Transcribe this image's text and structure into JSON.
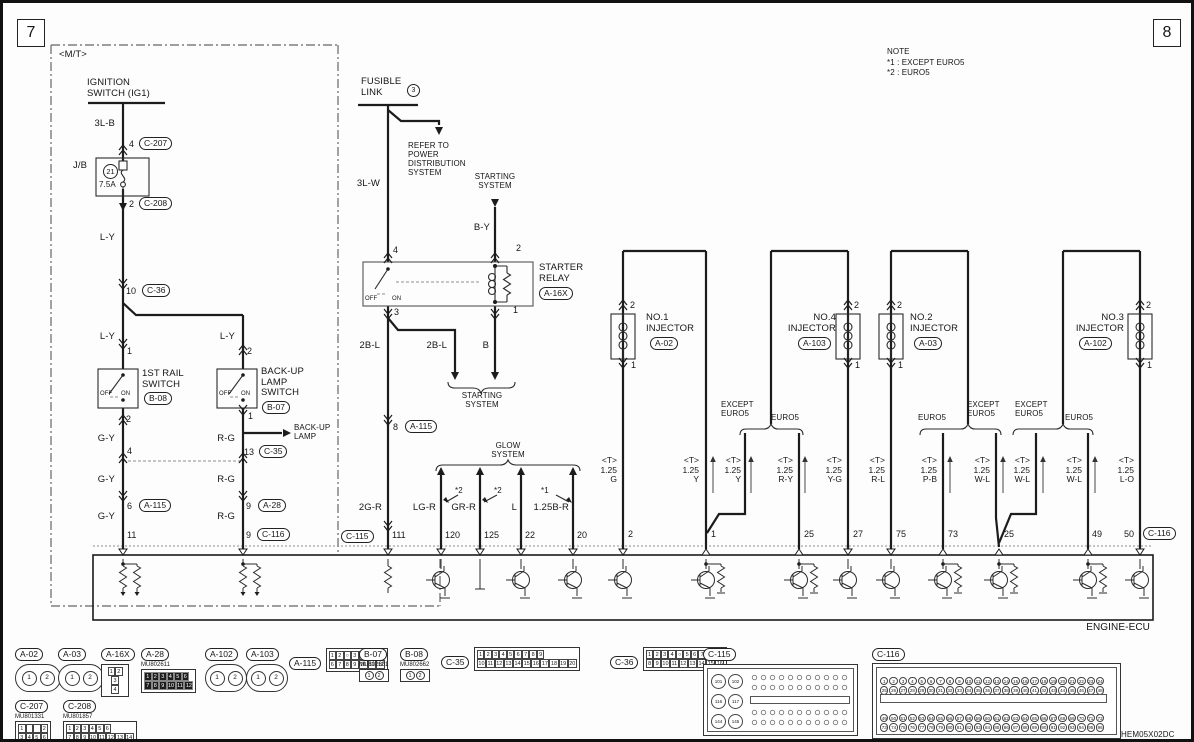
{
  "page": {
    "num_left": "7",
    "num_right": "8",
    "doc_code": "HEM05X02DC",
    "ecu_name": "ENGINE-ECU"
  },
  "note": {
    "title": "NOTE",
    "lines": [
      "*1 : EXCEPT EURO5",
      "*2 : EURO5"
    ]
  },
  "labels": {
    "mt": "<M/T>",
    "ignition": "IGNITION\nSWITCH (IG1)",
    "w3lb": "3L-B",
    "jb": "J/B",
    "fuse_no": "21",
    "fuse_amp": "7.5A",
    "ly": "L-Y",
    "gy": "G-Y",
    "rg": "R-G",
    "p4": "4",
    "p2": "2",
    "p10": "10",
    "p1": "1",
    "p13": "13",
    "p6": "6",
    "p9": "9",
    "p11": "11",
    "p8": "8",
    "rail_sw": "1ST RAIL\nSWITCH",
    "bul_sw": "BACK-UP\nLAMP\nSWITCH",
    "off": "OFF",
    "on": "ON",
    "backup_lamp": "BACK-UP\nLAMP",
    "fusible": "FUSIBLE\nLINK",
    "fl_no": "3",
    "refer": "REFER TO\nPOWER\nDISTRIBUTION\nSYSTEM",
    "w3lw": "3L-W",
    "starting": "STARTING\nSYSTEM",
    "by": "B-Y",
    "starter_relay": "STARTER\nRELAY",
    "rp4": "4",
    "rp2": "2",
    "rp3": "3",
    "rp1": "1",
    "b2l": "2B-L",
    "wb": "B",
    "glow": "GLOW\nSYSTEM",
    "s1": "*1",
    "s2": "*2",
    "w2gr": "2G-R",
    "wlgr": "LG-R",
    "wgrr": "GR-R",
    "wl": "L",
    "w125br": "1.25B-R",
    "p111": "111",
    "p120": "120",
    "p125": "125",
    "p22": "22",
    "p20": "20",
    "inj1": "NO.1\nINJECTOR",
    "inj2": "NO.2\nINJECTOR",
    "inj3": "NO.3\nINJECTOR",
    "inj4": "NO.4\nINJECTOR",
    "pin2": "2",
    "pin1": "1",
    "except_euro5": "EXCEPT\nEURO5",
    "euro5": "EURO5",
    "sg": "<T>\n1.25\nG",
    "sy": "<T>\n1.25\nY",
    "sry": "<T>\n1.25\nR-Y",
    "syg": "<T>\n1.25\nY-G",
    "srl": "<T>\n1.25\nR-L",
    "spb": "<T>\n1.25\nP-B",
    "swl": "<T>\n1.25\nW-L",
    "slo": "<T>\n1.25\nL-O",
    "ep2": "2",
    "ep1": "1",
    "ep25": "25",
    "ep27": "27",
    "ep75": "75",
    "ep73": "73",
    "ep49": "49",
    "ep50": "50"
  },
  "connectors": {
    "a02": {
      "label": "A-02",
      "pins": [
        "1",
        "2"
      ]
    },
    "a03": {
      "label": "A-03",
      "pins": [
        "1",
        "2"
      ]
    },
    "a16x": {
      "label": "A-16X",
      "row1": [
        "1",
        "2"
      ],
      "row2": [
        "3"
      ],
      "row3": [
        "4"
      ]
    },
    "a28": {
      "label": "A-28",
      "part": "MU802611",
      "row1": [
        "1",
        "2",
        "3",
        "4",
        "5",
        "6"
      ],
      "row2": [
        "7",
        "8",
        "9",
        "10",
        "11",
        "12"
      ]
    },
    "a102": {
      "label": "A-102",
      "pins": [
        "1",
        "2"
      ]
    },
    "a103": {
      "label": "A-103",
      "pins": [
        "1",
        "2"
      ]
    },
    "a115": {
      "label": "A-115",
      "row1": [
        "1",
        "2",
        "○",
        "3",
        "4",
        "5"
      ],
      "row2": [
        "6",
        "7",
        "8",
        "9",
        "10",
        "11",
        "12"
      ]
    },
    "b07": {
      "label": "B-07",
      "part": "MU802601",
      "pins": [
        "1",
        "2"
      ]
    },
    "b08": {
      "label": "B-08",
      "part": "MU802662",
      "pins": [
        "1",
        "2"
      ]
    },
    "c35": {
      "label": "C-35",
      "row1": [
        "1",
        "2",
        "3",
        "4",
        "5",
        "6",
        "7",
        "8",
        "9"
      ],
      "row2": [
        "10",
        "11",
        "12",
        "13",
        "14",
        "15",
        "16",
        "17",
        "18",
        "19",
        "20"
      ]
    },
    "c36": {
      "label": "C-36",
      "row1": [
        "1",
        "2",
        "3",
        "4",
        "○",
        "5",
        "6",
        "7"
      ],
      "row2": [
        "8",
        "9",
        "10",
        "11",
        "12",
        "13",
        "14",
        "15",
        "16"
      ]
    },
    "c115": {
      "label": "C-115",
      "big": [
        "101",
        "102",
        "116",
        "117",
        "144",
        "145"
      ]
    },
    "c116": {
      "label": "C-116",
      "row1": [
        1,
        2,
        3,
        4,
        5,
        6,
        7,
        8,
        9,
        10,
        11,
        12,
        13,
        14,
        15,
        16,
        17,
        18,
        19,
        20,
        21,
        22,
        23,
        24
      ],
      "row2": [
        25,
        26,
        27,
        28,
        29,
        30,
        31,
        32,
        33,
        34,
        35,
        36,
        37,
        38,
        39,
        40,
        41,
        42,
        43,
        44,
        45,
        46,
        47,
        48
      ],
      "row3": [
        49,
        50,
        51,
        52,
        53,
        54,
        55,
        56,
        57,
        58,
        59,
        60,
        61,
        62,
        63,
        64,
        65,
        66,
        67,
        68,
        69,
        70,
        71,
        72
      ],
      "row4": [
        73,
        74,
        75,
        76,
        77,
        78,
        79,
        80,
        81,
        82,
        83,
        84,
        85,
        86,
        87,
        88,
        89,
        90,
        91,
        92,
        93,
        94,
        95,
        96
      ]
    },
    "c207": {
      "label": "C-207",
      "part": "MU801331",
      "row1": [
        "1",
        "",
        "",
        "2"
      ],
      "row2": [
        "3",
        "4",
        "5",
        "6"
      ]
    },
    "c208": {
      "label": "C-208",
      "part": "MU801857",
      "row1": [
        "1",
        "2",
        "3",
        "4",
        "5",
        "6"
      ],
      "row2": [
        "7",
        "8",
        "9",
        "10",
        "11",
        "12",
        "13",
        "14"
      ]
    }
  }
}
